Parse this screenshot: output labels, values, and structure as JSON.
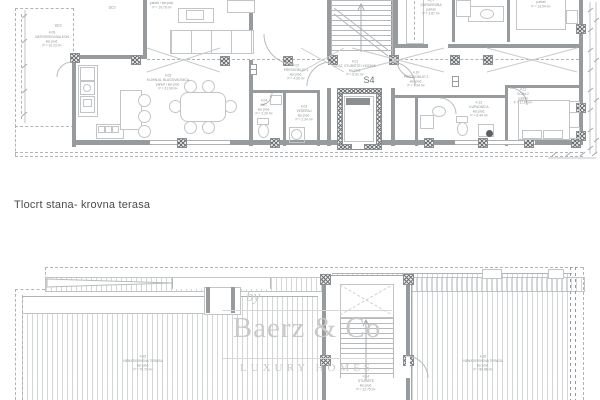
{
  "title": "Tlocrt stana- krovna terasa",
  "unit_label": "S4",
  "watermark": {
    "by": "by",
    "brand": "Baerz & Co",
    "tagline": "LUXURY HOMES"
  },
  "annotations": {
    "riser_note": "28+0"
  },
  "colors": {
    "line": "#c2c5c7",
    "wall": "#979b9e",
    "label_text": "#8d9194",
    "watermark": "#c9c9c9",
    "title_text": "#4b4b4b",
    "background": "#ffffff"
  },
  "upper_plan": {
    "name": "Tlocrt stana",
    "rooms": [
      {
        "num": "4.09",
        "label": "NATKRIVENI BALKON",
        "floor": "ker.ploč.",
        "area": "P = 10.23 m²"
      },
      {
        "num": "",
        "label": "",
        "floor": "parket / ker.ploč.",
        "area": "P = 19.76 m²"
      },
      {
        "num": "4.05",
        "label": "KUHINJA, BLAGOVAONICA",
        "floor": "parket / ker.ploč.",
        "area": "P = 21.09 m²"
      },
      {
        "num": "4.02",
        "label": "PREDSOBLJE 1",
        "floor": "ker.ploč.",
        "area": "P = 4.30 m²"
      },
      {
        "num": "4.01",
        "label": "ULAZ, STUBIŠTE I HODNIK",
        "floor": "ker.ploč.",
        "area": "P = 6.91 m²"
      },
      {
        "num": "4.07",
        "label": "GARDEROBA",
        "floor": "parket",
        "area": "P = 3.87 m²"
      },
      {
        "num": "",
        "label": "",
        "floor": "parket",
        "area": "P = 13.54 m²"
      },
      {
        "num": "4.10",
        "label": "PREDSOBLJE 2",
        "floor": "ker.ploč.",
        "area": "P = 7.34 m²"
      },
      {
        "num": "4.04",
        "label": "WC",
        "floor": "ker.ploč.",
        "area": "P = 2.20 m²"
      },
      {
        "num": "4.03",
        "label": "VEŠERAJ",
        "floor": "ker.ploč.",
        "area": "P = 2.34 m²"
      },
      {
        "num": "4.12",
        "label": "KUPAONICA",
        "floor": "ker.ploč.",
        "area": "P = 6.44 m²"
      },
      {
        "num": "4.11",
        "label": "SOBA 2",
        "floor": "parket",
        "area": "P = 11.95 m²"
      }
    ]
  },
  "lower_plan": {
    "name": "krovna terasa",
    "rooms": [
      {
        "num": "4.15",
        "label": "NENATKRIVENA TERASA",
        "floor": "ker.ploč.",
        "area": "P = 79.72 m²"
      },
      {
        "num": "4.16",
        "label": "NENATKRIVENA TERASA",
        "floor": "ker.ploč.",
        "area": "P = 80.86 m²"
      },
      {
        "num": "4.14",
        "label": "STUBIŠTE",
        "floor": "ker.ploč.",
        "area": "P = 12.75 m²"
      }
    ]
  }
}
